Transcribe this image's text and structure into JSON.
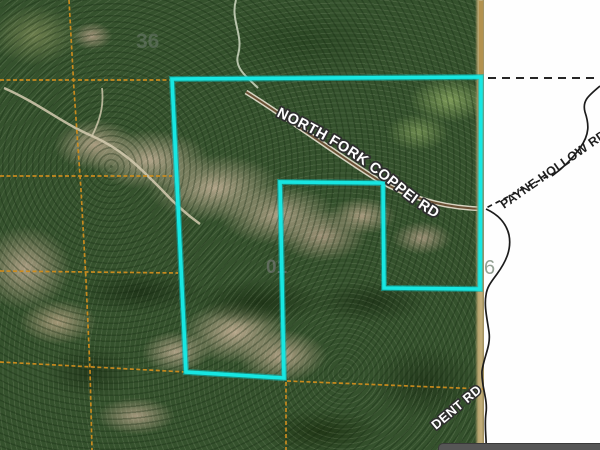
{
  "map": {
    "road_labels": {
      "north_fork_coppei": "NORTH FORK COPPEI RD",
      "payne_hollow": "PAYNE HOLLOW RD",
      "dent": "DENT RD"
    },
    "section_numbers": {
      "northwest": "36",
      "center": "01",
      "east": "6"
    },
    "colors": {
      "parcel_highlight": "#17e7e2",
      "parcel_highlight_dark": "#0ab9b9",
      "section_line": "#cf8d1e",
      "road_line": "#1c1c1c",
      "boundary_dash": "#262626",
      "imagery_edge_line": "#b1914f",
      "road_label_fill": "#ffffff",
      "road_label_halo": "#2e2e2e",
      "payne_label_fill": "#1f1f1f",
      "section_number_gray": "#7d7d7d",
      "section_number_faint": "#6f7d6f",
      "section_number_east": "#95a295"
    }
  }
}
